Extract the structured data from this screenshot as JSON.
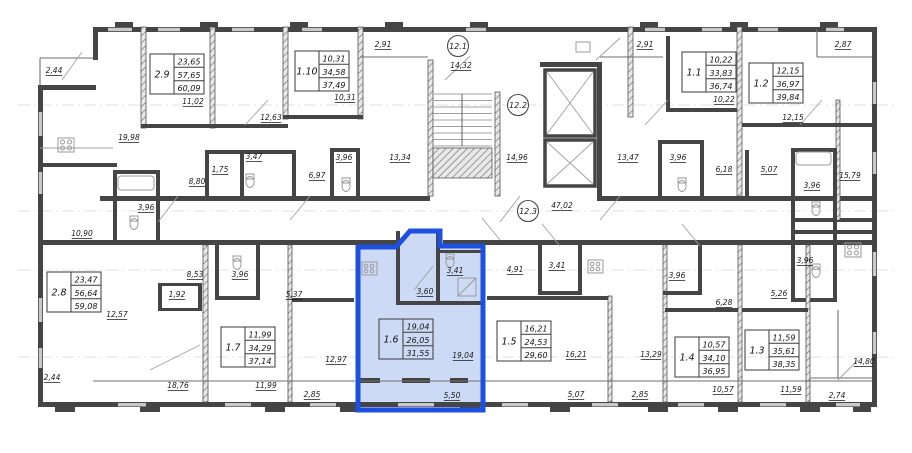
{
  "floorplan": {
    "colors": {
      "highlight_stroke": "#1d4fe0",
      "highlight_fill": "#cddaf5",
      "wall": "#454545",
      "text": "#1a1a1a"
    },
    "units": [
      {
        "id": "2.9",
        "x": 150,
        "y": 54,
        "values": [
          "23,65",
          "57,65",
          "60,09"
        ],
        "highlighted": false
      },
      {
        "id": "1.10",
        "x": 295,
        "y": 51,
        "values": [
          "10,31",
          "34,58",
          "37,49"
        ],
        "highlighted": false
      },
      {
        "id": "1.1",
        "x": 682,
        "y": 52,
        "values": [
          "10,22",
          "33,83",
          "36,74"
        ],
        "highlighted": false
      },
      {
        "id": "1.2",
        "x": 749,
        "y": 63,
        "values": [
          "12,15",
          "36,97",
          "39,84"
        ],
        "highlighted": false
      },
      {
        "id": "2.8",
        "x": 47,
        "y": 272,
        "values": [
          "23,47",
          "56,64",
          "59,08"
        ],
        "highlighted": false
      },
      {
        "id": "1.7",
        "x": 221,
        "y": 327,
        "values": [
          "11,99",
          "34,29",
          "37,14"
        ],
        "highlighted": false
      },
      {
        "id": "1.6",
        "x": 379,
        "y": 319,
        "values": [
          "19,04",
          "26,05",
          "31,55"
        ],
        "highlighted": true
      },
      {
        "id": "1.5",
        "x": 497,
        "y": 321,
        "values": [
          "16,21",
          "24,53",
          "29,60"
        ],
        "highlighted": false
      },
      {
        "id": "1.4",
        "x": 675,
        "y": 337,
        "values": [
          "10,57",
          "34,10",
          "36,95"
        ],
        "highlighted": false
      },
      {
        "id": "1.3",
        "x": 745,
        "y": 330,
        "values": [
          "11,59",
          "35,61",
          "38,35"
        ],
        "highlighted": false
      }
    ],
    "dimensions": [
      {
        "t": "2,44",
        "x": 54,
        "y": 73
      },
      {
        "t": "19,98",
        "x": 129,
        "y": 140
      },
      {
        "t": "11,02",
        "x": 193,
        "y": 104
      },
      {
        "t": "12,63",
        "x": 271,
        "y": 120
      },
      {
        "t": "10,31",
        "x": 345,
        "y": 100
      },
      {
        "t": "2,91",
        "x": 383,
        "y": 47
      },
      {
        "t": "14,32",
        "x": 461,
        "y": 68
      },
      {
        "t": "2,91",
        "x": 645,
        "y": 47
      },
      {
        "t": "10,22",
        "x": 724,
        "y": 102
      },
      {
        "t": "12,15",
        "x": 793,
        "y": 120
      },
      {
        "t": "2,87",
        "x": 843,
        "y": 47
      },
      {
        "t": "3,47",
        "x": 254,
        "y": 159
      },
      {
        "t": "1,75",
        "x": 220,
        "y": 172
      },
      {
        "t": "8,80",
        "x": 197,
        "y": 184
      },
      {
        "t": "3,96",
        "x": 146,
        "y": 210
      },
      {
        "t": "10,90",
        "x": 82,
        "y": 236
      },
      {
        "t": "6,97",
        "x": 317,
        "y": 178
      },
      {
        "t": "3,96",
        "x": 344,
        "y": 160
      },
      {
        "t": "13,34",
        "x": 400,
        "y": 160
      },
      {
        "t": "14,96",
        "x": 517,
        "y": 160
      },
      {
        "t": "47,02",
        "x": 562,
        "y": 208
      },
      {
        "t": "13,47",
        "x": 628,
        "y": 160
      },
      {
        "t": "3,96",
        "x": 678,
        "y": 160
      },
      {
        "t": "6,18",
        "x": 724,
        "y": 172
      },
      {
        "t": "5,07",
        "x": 769,
        "y": 172
      },
      {
        "t": "3,96",
        "x": 812,
        "y": 188
      },
      {
        "t": "15,79",
        "x": 850,
        "y": 178
      },
      {
        "t": "3,96",
        "x": 805,
        "y": 263
      },
      {
        "t": "8,53",
        "x": 195,
        "y": 277
      },
      {
        "t": "3,96",
        "x": 240,
        "y": 277
      },
      {
        "t": "1,92",
        "x": 177,
        "y": 297
      },
      {
        "t": "5,37",
        "x": 294,
        "y": 297
      },
      {
        "t": "12,57",
        "x": 117,
        "y": 317
      },
      {
        "t": "2,44",
        "x": 52,
        "y": 380
      },
      {
        "t": "18,76",
        "x": 178,
        "y": 388
      },
      {
        "t": "11,99",
        "x": 266,
        "y": 388
      },
      {
        "t": "12,97",
        "x": 336,
        "y": 362
      },
      {
        "t": "2,85",
        "x": 312,
        "y": 397
      },
      {
        "t": "3,60",
        "x": 425,
        "y": 294
      },
      {
        "t": "3,41",
        "x": 455,
        "y": 273
      },
      {
        "t": "19,04",
        "x": 463,
        "y": 358
      },
      {
        "t": "5,50",
        "x": 452,
        "y": 398
      },
      {
        "t": "4,91",
        "x": 515,
        "y": 272
      },
      {
        "t": "3,41",
        "x": 557,
        "y": 268
      },
      {
        "t": "16,21",
        "x": 576,
        "y": 357
      },
      {
        "t": "5,07",
        "x": 576,
        "y": 397
      },
      {
        "t": "13,29",
        "x": 651,
        "y": 357
      },
      {
        "t": "2,85",
        "x": 640,
        "y": 397
      },
      {
        "t": "3,96",
        "x": 677,
        "y": 278
      },
      {
        "t": "6,28",
        "x": 724,
        "y": 305
      },
      {
        "t": "5,26",
        "x": 779,
        "y": 296
      },
      {
        "t": "10,57",
        "x": 723,
        "y": 392
      },
      {
        "t": "11,59",
        "x": 791,
        "y": 392
      },
      {
        "t": "14,80",
        "x": 864,
        "y": 364
      },
      {
        "t": "2,74",
        "x": 837,
        "y": 398
      }
    ],
    "markers": [
      {
        "id": "12.1",
        "x": 458,
        "y": 46
      },
      {
        "id": "12.2",
        "x": 518,
        "y": 105
      },
      {
        "id": "12.3",
        "x": 528,
        "y": 211
      }
    ]
  }
}
